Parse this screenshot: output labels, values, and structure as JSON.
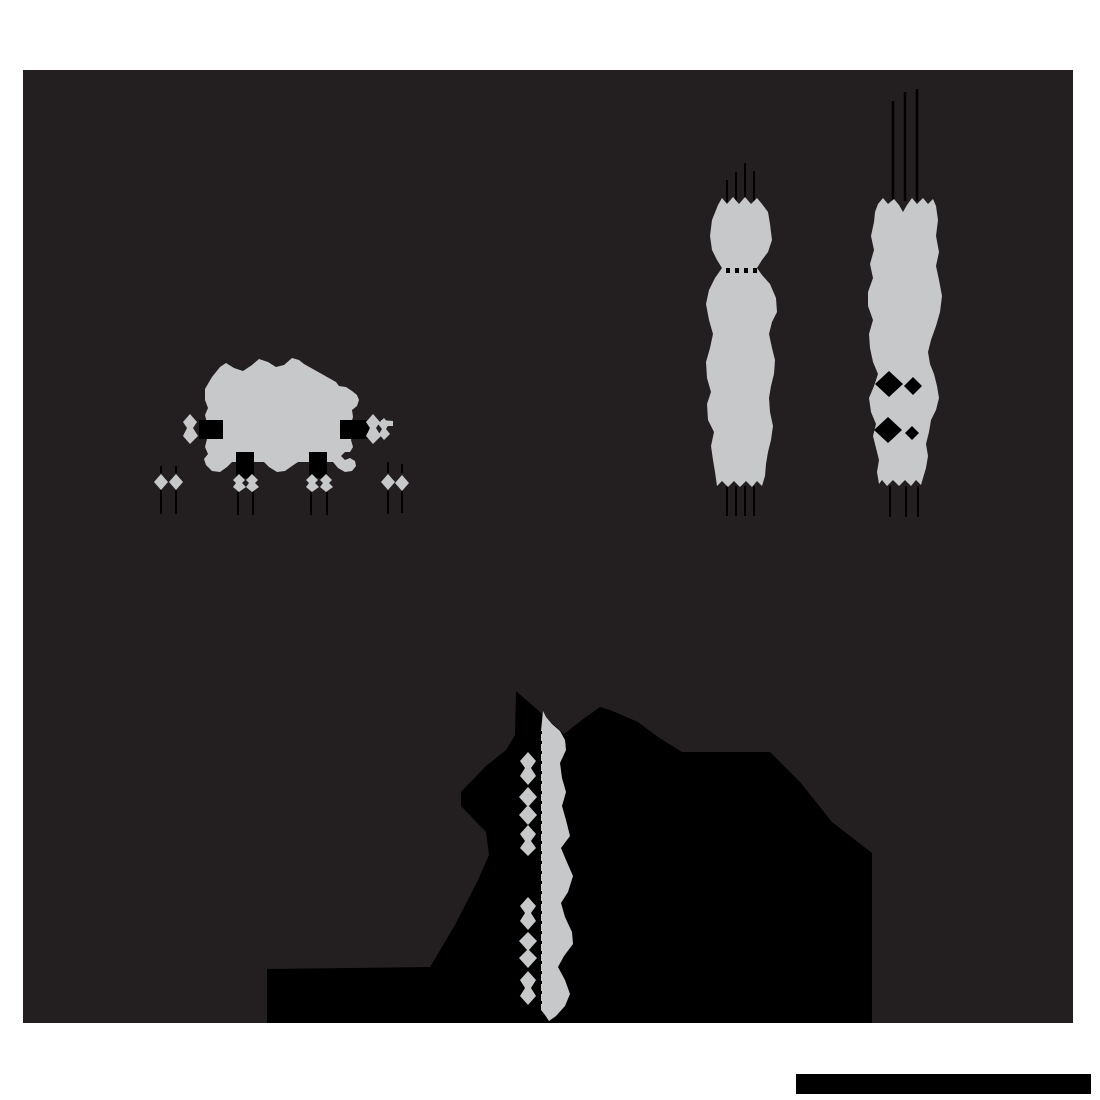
{
  "canvas": {
    "width": 1100,
    "height": 1100
  },
  "palette": {
    "page_bg": "#ffffff",
    "panel_bg": "#231f20",
    "shade_gray": "#c6c8ca",
    "ink_black": "#000000"
  },
  "figure": {
    "panel": {
      "d": "M23,70 H1073 V1023 H23 Z"
    },
    "scale_bar": {
      "d": "M796,1074 H1091 V1094 H796 Z"
    },
    "shadow_mass": {
      "d": "M516,691 L515,735 L506,750 L486,766 L461,792 L461,806 L486,832 L489,855 L478,880 L455,925 L430,967 L267,969 L267,1023 L872,1023 L872,853 L832,822 L800,782 L770,752 L682,752 L658,737 L638,722 L610,710 L600,707 L582,720 L564,734 L540,712 Z"
    },
    "equipment_block": {
      "body": {
        "d": "M205,389 L212,377 L220,367 L226,363 L234,368 L243,371 L252,365 L259,359 L268,362 L276,367 L284,365 L292,358 L299,360 L304,364 L336,382 L339,386 L346,387 L352,391 L357,395 L359,400 L357,406 L352,410 L353,417 L351,424 L353,432 L351,440 L353,447 L350,452 L345,452 L341,456 L345,460 L350,458 L355,461 L356,466 L352,471 L345,472 L338,468 L333,462 L298,462 L292,466 L285,471 L277,472 L269,467 L264,462 L232,462 L227,467 L220,472 L212,471 L206,465 L204,459 L208,454 L205,447 L207,439 L205,431 L207,423 L205,415 L208,408 L205,400 Z"
      },
      "side_fittings": {
        "d": "M190,414 L197,422 L193,428 L198,436 L190,444 L183,436 L187,428 L183,422 Z M373,414 L380,422 L376,428 L381,436 L373,444 L366,436 L370,428 L366,422 Z M384,418 L389,424 L386,429 L390,434 L384,440 L379,434 L382,429 L378,424 Z M381,420 L393,421 L393,426 L381,426 Z"
      },
      "ink_notches": {
        "d": "M199,420 H223 V439 H199 Z M340,420 H369 V439 H340 Z M236,452 H254 V478 H236 Z M309,452 H327 V478 H309 Z"
      },
      "nozzle_diamonds": {
        "d": "M161,474 L168,482 L161,490 L154,482 Z M176,474 L183,482 L176,490 L169,482 Z M388,474 L395,482 L388,490 L381,482 Z M402,475 L409,483 L402,491 L395,483 Z M239,474 L245,480 L242,483 L246,487 L239,492 L233,487 L236,483 L233,480 Z M252,474 L258,480 L255,483 L259,487 L252,492 L246,487 L249,483 L246,480 Z M312,474 L318,480 L315,483 L319,487 L312,492 L306,487 L309,483 L306,480 Z M326,474 L332,480 L329,483 L333,487 L326,492 L320,487 L323,483 L320,480 Z"
      },
      "drop_lines": {
        "d": "M161,490 V514 M176,490 V514 M238,492 V515 M253,492 V515 M311,492 V515 M327,492 V515 M388,491 V514 M402,491 V513"
      },
      "stub_lines": {
        "d": "M161,466 V473 M176,466 V473 M388,462 V473 M402,464 V473"
      }
    },
    "tower_left": {
      "body": {
        "d": "M718,205 L722,198 L727,204 L733,197 L739,204 L745,197 L751,204 L757,198 L762,204 L768,212 L770,224 L772,240 L768,252 L762,260 L757,268 L762,275 L770,284 L776,298 L777,312 L772,322 L769,334 L772,348 L775,360 L774,374 L771,386 L769,398 L770,412 L773,426 L771,440 L768,452 L766,464 L765,476 L762,486 L757,481 L752,487 L746,481 L740,487 L734,481 L728,487 L722,481 L717,486 L715,472 L713,460 L711,446 L714,432 L708,420 L707,404 L711,392 L707,378 L706,362 L710,348 L713,334 L709,320 L706,304 L709,290 L715,278 L722,268 L717,260 L712,250 L710,236 L712,220 Z"
      },
      "gap_dots": {
        "d": "M726,268 h4 v5 h-4 Z M735,268 h4 v5 h-4 Z M744,268 h4 v5 h-4 Z M753,268 h4 v5 h-4 Z"
      },
      "lines_top": {
        "d": "M727,180 V202 M736,172 V202 M745,163 V202 M754,171 V202"
      },
      "lines_bottom": {
        "d": "M727,486 V516 M736,486 V516 M745,486 V516 M754,486 V516"
      }
    },
    "tower_right": {
      "body": {
        "d": "M878,204 L883,198 L888,204 L894,199 L899,205 L903,212 L907,205 L912,198 L917,204 L923,198 L928,204 L933,199 L936,206 L938,220 L936,236 L939,252 L936,266 L939,280 L942,296 L940,312 L936,326 L931,340 L928,352 L930,364 L934,374 L937,386 L939,398 L936,410 L931,420 L929,432 L926,444 L928,456 L926,468 L923,478 L921,485 L916,480 L911,486 L905,480 L899,486 L893,480 L887,486 L882,480 L879,484 L877,472 L879,460 L876,448 L873,436 L876,424 L871,412 L869,398 L874,386 L878,374 L873,362 L870,348 L869,334 L873,320 L868,306 L868,292 L873,278 L870,264 L874,250 L871,236 L874,222 L875,212 Z"
      },
      "gap_cuts": {
        "d": "M875,384 L889,371 L903,384 L889,397 Z M904,386 L913,377 L922,386 L913,395 Z M874,430 L888,417 L902,430 L888,443 Z M905,433 L912,426 L919,433 L912,440 Z"
      },
      "lines_top": {
        "d": "M893,101 V201 M905,92 V201 M917,89 V201"
      },
      "lines_bottom": {
        "d": "M890,486 V517 M906,486 V517 M918,486 V517"
      }
    },
    "vessel_strip": {
      "body": {
        "d": "M543,711 L546,717 L552,724 L560,731 L565,740 L566,750 L560,763 L562,778 L566,792 L562,806 L566,820 L570,836 L561,848 L566,860 L573,876 L568,892 L561,903 L565,917 L572,932 L573,944 L564,956 L558,967 L565,980 L570,994 L565,1006 L556,1016 L549,1021 L545,1015 L541,1010 L541,731 Z"
      },
      "fitting_diamonds": {
        "d": "M528,752 L536,761 L531,768 L536,776 L528,785 L520,776 L525,768 L520,761 Z M528,787 L537,797 L528,807 L519,797 Z M528,805 L537,815 L528,825 L519,815 Z M528,825 L536,834 L531,841 L536,848 L528,856 L520,848 L525,841 L520,834 Z M528,897 L536,906 L531,913 L536,921 L528,930 L520,921 L525,913 L520,906 Z M528,932 L537,941 L528,951 L519,941 Z M528,949 L537,958 L528,968 L519,958 Z M528,971 L536,980 L531,988 L536,996 L528,1005 L520,996 L525,988 L520,980 Z"
      },
      "tick_line": {
        "d": "M541,731 V1012"
      }
    }
  }
}
